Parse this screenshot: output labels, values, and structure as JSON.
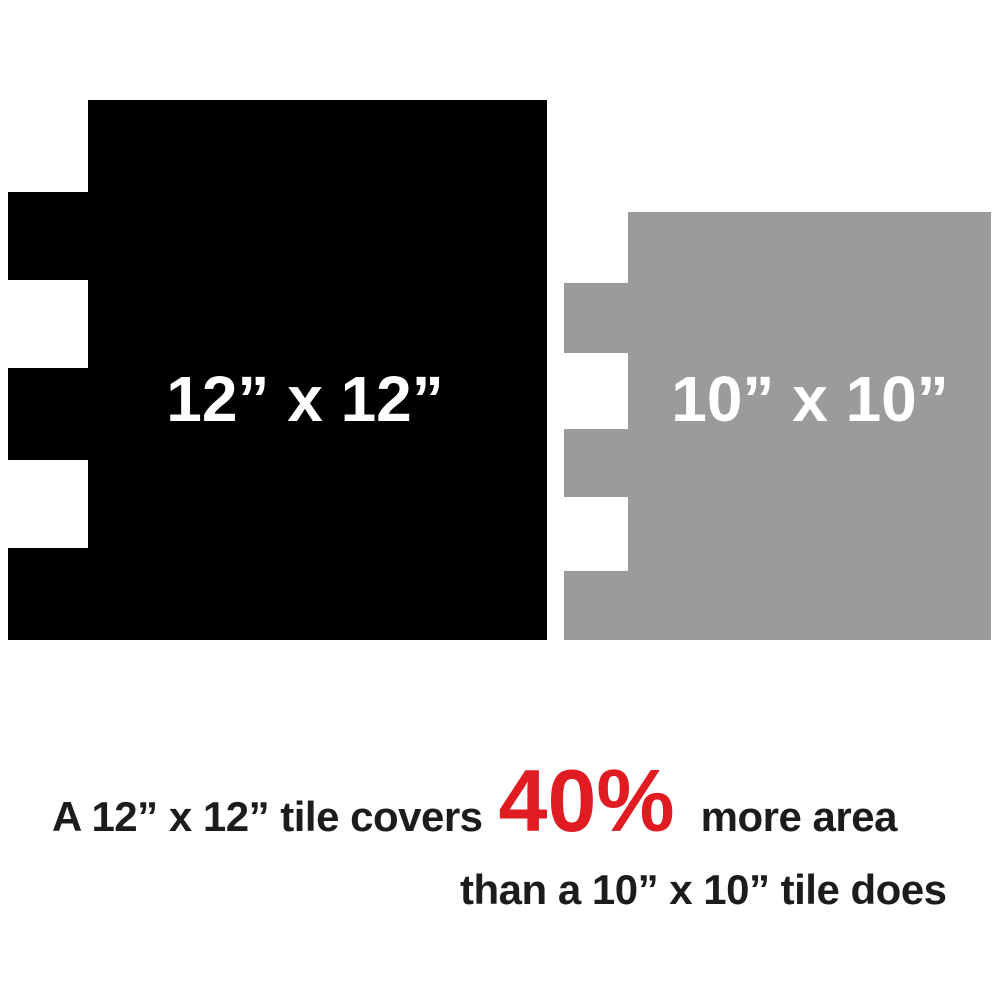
{
  "canvas": {
    "background_color": "#ffffff"
  },
  "tiles": {
    "large": {
      "label": "12” x 12”",
      "color": "#000000",
      "label_color": "#ffffff"
    },
    "small": {
      "label": "10” x 10”",
      "color": "#9b9b9b",
      "label_color": "#ffffff"
    }
  },
  "caption": {
    "line1_prefix": "A 12” x 12” tile covers",
    "highlight": "40%",
    "line1_suffix": "more area",
    "line2": "than a 10” x 10” tile does",
    "text_color": "#1c1c1c",
    "highlight_color": "#e01b22"
  }
}
